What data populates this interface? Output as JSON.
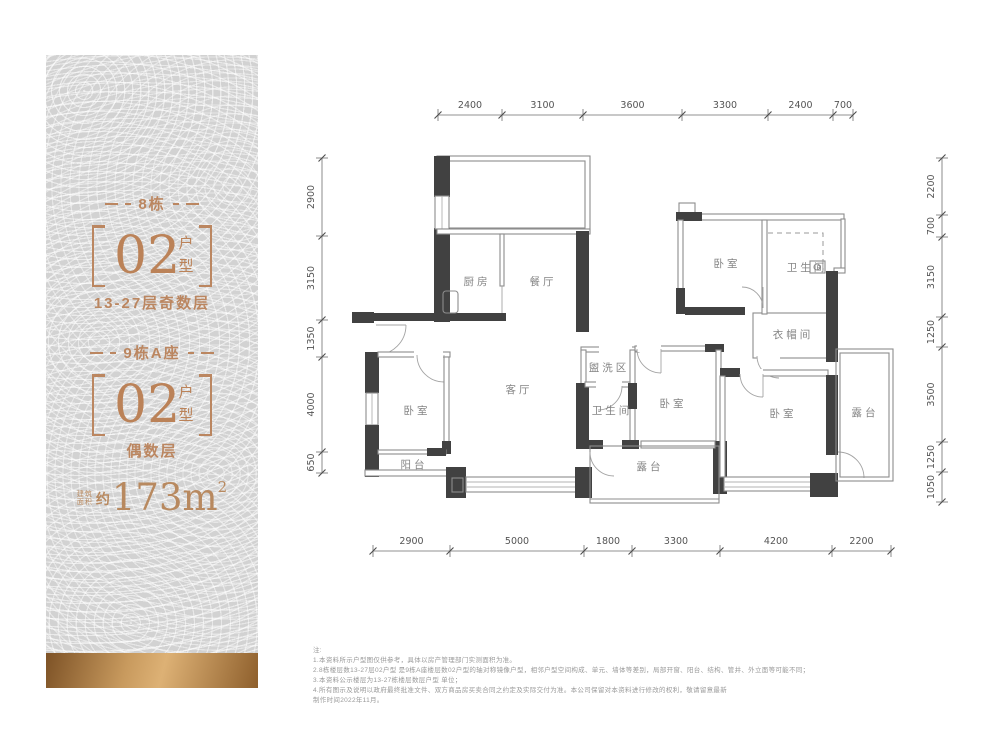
{
  "sidebar": {
    "accent_color": "#bb8660",
    "section1": {
      "building": "8栋",
      "unit_number": "02",
      "unit_label": "户型",
      "floors": "13-27层奇数层"
    },
    "section2": {
      "building": "9栋A座",
      "unit_number": "02",
      "unit_label": "户型",
      "floors": "偶数层"
    },
    "area": {
      "prefix_top": "建筑",
      "prefix_bottom": "面积",
      "approx": "约",
      "value": "173m",
      "superscript": "2"
    }
  },
  "plan": {
    "rooms": [
      {
        "id": "kitchen",
        "label": "厨房"
      },
      {
        "id": "dining-room",
        "label": "餐厅"
      },
      {
        "id": "bedroom-top-right",
        "label": "卧室"
      },
      {
        "id": "bathroom-top-right",
        "label": "卫生间"
      },
      {
        "id": "cloakroom",
        "label": "衣帽间"
      },
      {
        "id": "wash-area",
        "label": "盥洗区"
      },
      {
        "id": "living-room",
        "label": "客厅"
      },
      {
        "id": "bedroom-left",
        "label": "卧室"
      },
      {
        "id": "bathroom-middle",
        "label": "卫生间"
      },
      {
        "id": "bedroom-middle",
        "label": "卧室"
      },
      {
        "id": "bedroom-right",
        "label": "卧室"
      },
      {
        "id": "terrace-right",
        "label": "露台"
      },
      {
        "id": "balcony",
        "label": "阳台"
      },
      {
        "id": "terrace-bottom",
        "label": "露台"
      }
    ],
    "dims_top": [
      "2400",
      "3100",
      "3600",
      "3300",
      "2400",
      "700"
    ],
    "dims_bottom": [
      "2900",
      "5000",
      "1800",
      "3300",
      "4200",
      "2200"
    ],
    "dims_left": [
      "2900",
      "3150",
      "1350",
      "4000",
      "650"
    ],
    "dims_right": [
      "2200",
      "700",
      "3150",
      "1250",
      "3500",
      "1250",
      "1050"
    ]
  },
  "notes": {
    "title": "注:",
    "lines": [
      "1.本资料所示户型图仅供参考，具体以房产管理部门实测面积为准。",
      "2.8栋楼层数13-27层02户型 是9栋A座楼层数02户型的轴对称镜像户型，相邻户型空间构成、单元、墙体等差别，局部开窗、阳台、结构、管井、外立面等可能不同；",
      "3.本资料公示楼层为13-27栋楼层数层户型 单位；",
      "4.所有图示及说明以政府最终批准文件、双方商品房买卖合同之约定及实际交付为准。本公司保留对本资料进行修改的权利，敬请留意最新",
      "制作时间2022年11月。"
    ]
  }
}
